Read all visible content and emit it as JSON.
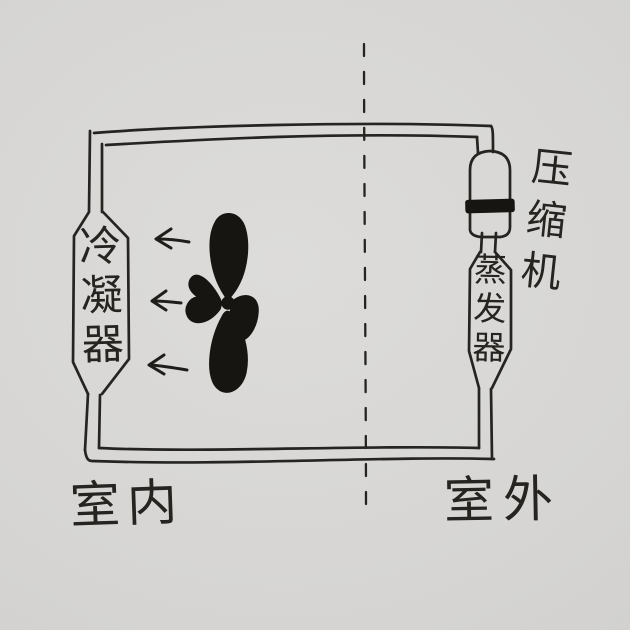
{
  "diagram": {
    "labels": {
      "condenser": "冷凝器",
      "compressor": "压缩机",
      "evaporator": "蒸发器",
      "indoor": "室内",
      "outdoor": "室外"
    },
    "airflow_arrows": {
      "count": 3,
      "direction": "left"
    },
    "fan": {
      "blade_count": 4
    },
    "partition": {
      "style": "dashed",
      "orientation": "vertical"
    },
    "colors": {
      "paper": "#d5d4d2",
      "ink": "#262420"
    }
  }
}
